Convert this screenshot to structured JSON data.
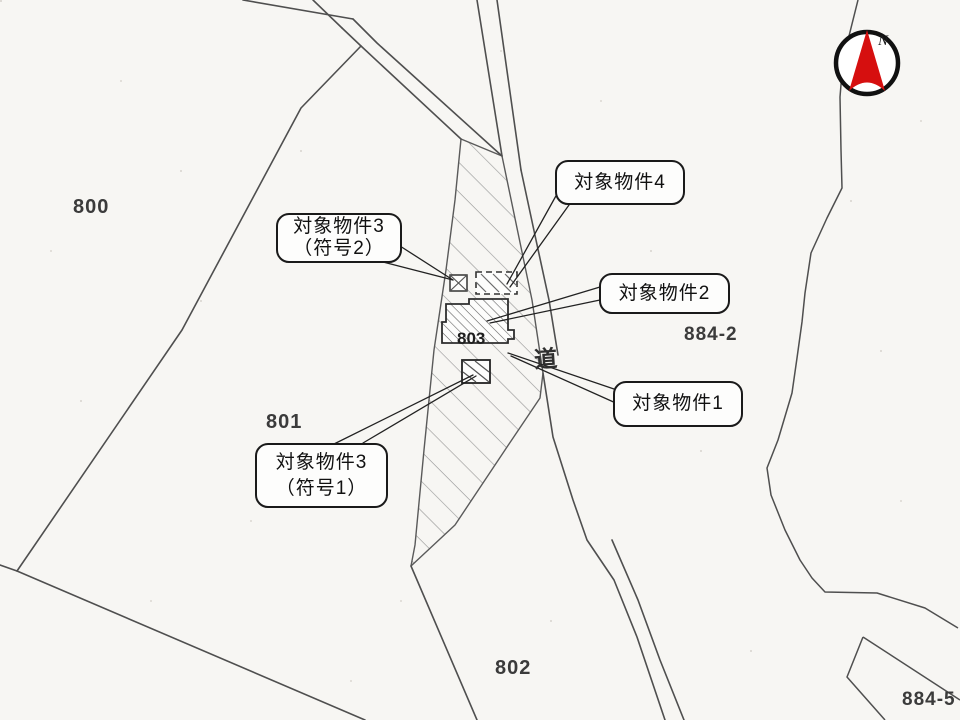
{
  "parcels": [
    {
      "label": "800"
    },
    {
      "label": "801"
    },
    {
      "label": "802"
    },
    {
      "label": "803"
    },
    {
      "label": "884-2"
    },
    {
      "label": "884-5"
    }
  ],
  "road_label": "道",
  "callouts": [
    {
      "id": "target-4",
      "line1": "対象物件4",
      "line2": ""
    },
    {
      "id": "target-3-sign2",
      "line1": "対象物件3",
      "line2": "（符号2）"
    },
    {
      "id": "target-2",
      "line1": "対象物件2",
      "line2": ""
    },
    {
      "id": "target-1",
      "line1": "対象物件1",
      "line2": ""
    },
    {
      "id": "target-3-sign1",
      "line1": "対象物件3",
      "line2": "（符号1）"
    }
  ],
  "compass": {
    "label": "N"
  },
  "colors": {
    "paper": "#f7f6f3",
    "boundary_line": "#4f4f4f",
    "hatch_light": "#979797",
    "hatch_dense": "#5f5f5f",
    "compass_red": "#d60f0f",
    "callout_border": "#1a1a1a"
  }
}
